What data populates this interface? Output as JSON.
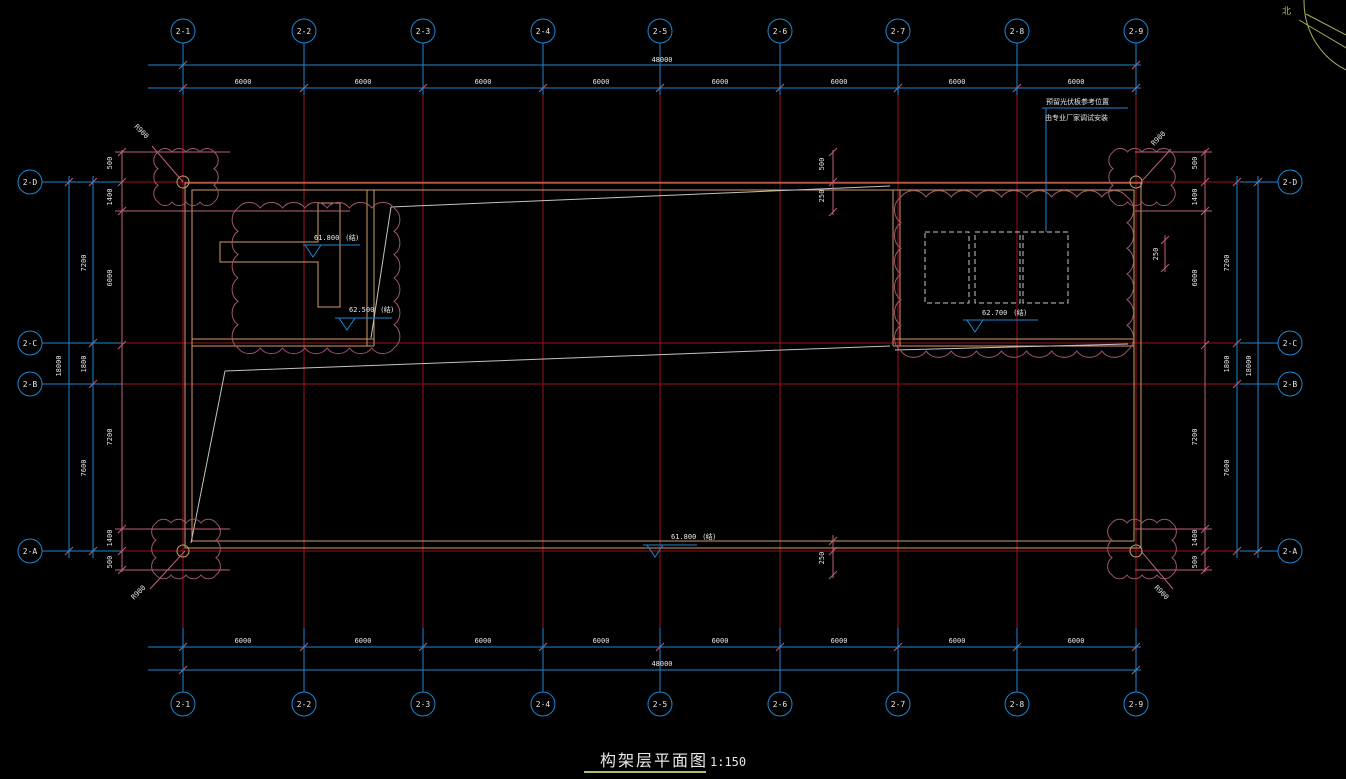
{
  "title_block": {
    "title": "构架层平面图",
    "scale": "1:150"
  },
  "north": {
    "label": "北"
  },
  "grid": {
    "cols": [
      "2-1",
      "2-2",
      "2-3",
      "2-4",
      "2-5",
      "2-6",
      "2-7",
      "2-8",
      "2-9"
    ],
    "rows": [
      "2-D",
      "2-C",
      "2-B",
      "2-A"
    ],
    "bay_width": "6000",
    "top_total": "48000",
    "bottom_total": "48000",
    "left_total": "18000",
    "right_total": "18000",
    "row_spacings": [
      "7200",
      "1800",
      "7600"
    ],
    "edge_offsets": [
      "500",
      "1400",
      "6000",
      "7200",
      "1400",
      "500"
    ],
    "small_offsets": {
      "top_a": "500",
      "top_b": "250",
      "bottom": "250",
      "right": "250"
    }
  },
  "levels": [
    {
      "value": "61.800",
      "tag": "(结)"
    },
    {
      "value": "62.500",
      "tag": "(结)"
    },
    {
      "value": "62.700",
      "tag": "(结)"
    },
    {
      "value": "61.800",
      "tag": "(结)"
    }
  ],
  "annotation": {
    "line1": "预留光伏板参考位置",
    "line2": "由专业厂家调试安装"
  },
  "corner_note": "R900"
}
